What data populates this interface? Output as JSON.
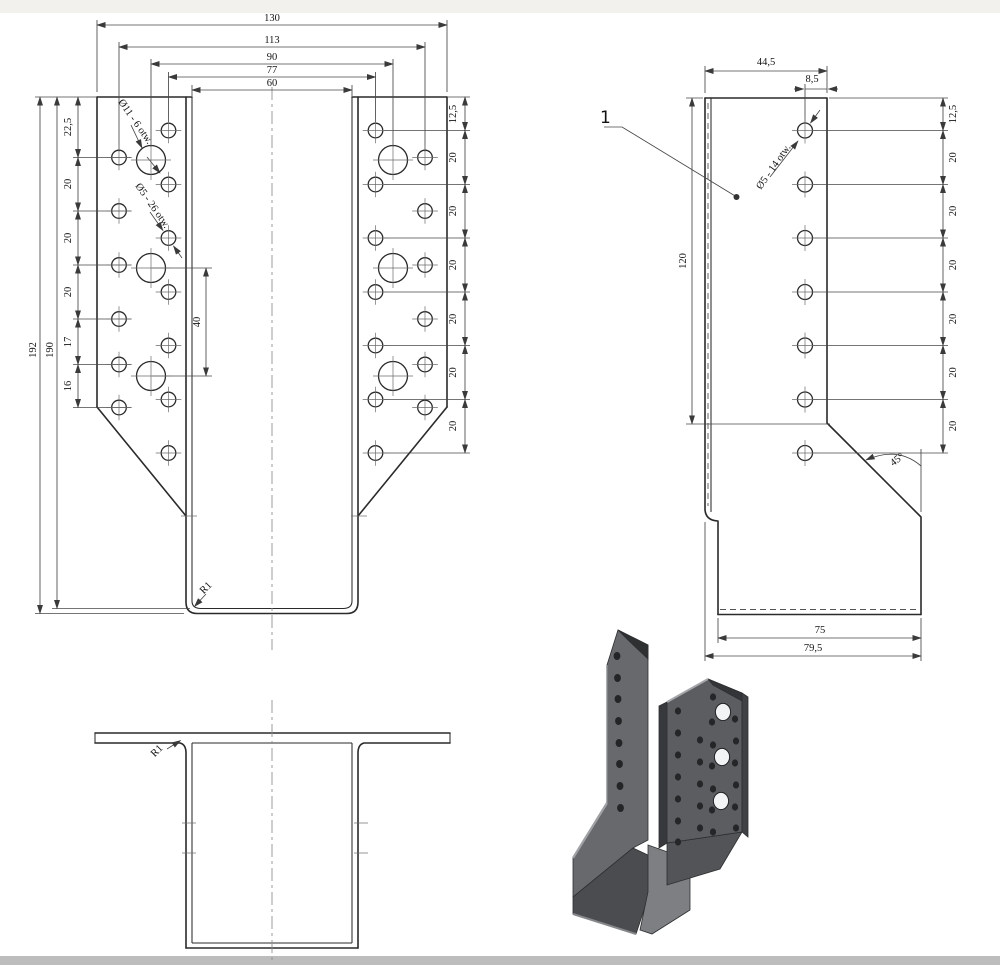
{
  "colors": {
    "outline": "#2a2a2a",
    "dimension": "#474747",
    "metal_gray": "#5b5d60",
    "band_top": "#f2f1ee",
    "band_bottom": "#bdbdbd"
  },
  "front_view": {
    "dims_top": [
      "130",
      "113",
      "90",
      "77",
      "60"
    ],
    "dim_height_outer": "192",
    "dim_height_inner": "190",
    "chain_left": [
      "22,5",
      "20",
      "20",
      "20",
      "17",
      "16"
    ],
    "chain_right": [
      "12,5",
      "20",
      "20",
      "20",
      "20",
      "20",
      "20"
    ],
    "dim_hole_spacing": "40",
    "label_large_holes": "Ø11 - 6 otw.",
    "label_small_holes": "Ø5 - 26 otw.",
    "label_radius": "R1"
  },
  "side_view": {
    "dim_flange_width": "44,5",
    "dim_hole_edge": "8,5",
    "dim_height": "120",
    "chain_right": [
      "12,5",
      "20",
      "20",
      "20",
      "20",
      "20",
      "20"
    ],
    "dim_seat": "75",
    "dim_base": "79,5",
    "label_angle": "45°",
    "label_holes": "Ø5 - 14 otw.",
    "callout": "1"
  },
  "bottom_view": {
    "label_radius": "R1"
  }
}
